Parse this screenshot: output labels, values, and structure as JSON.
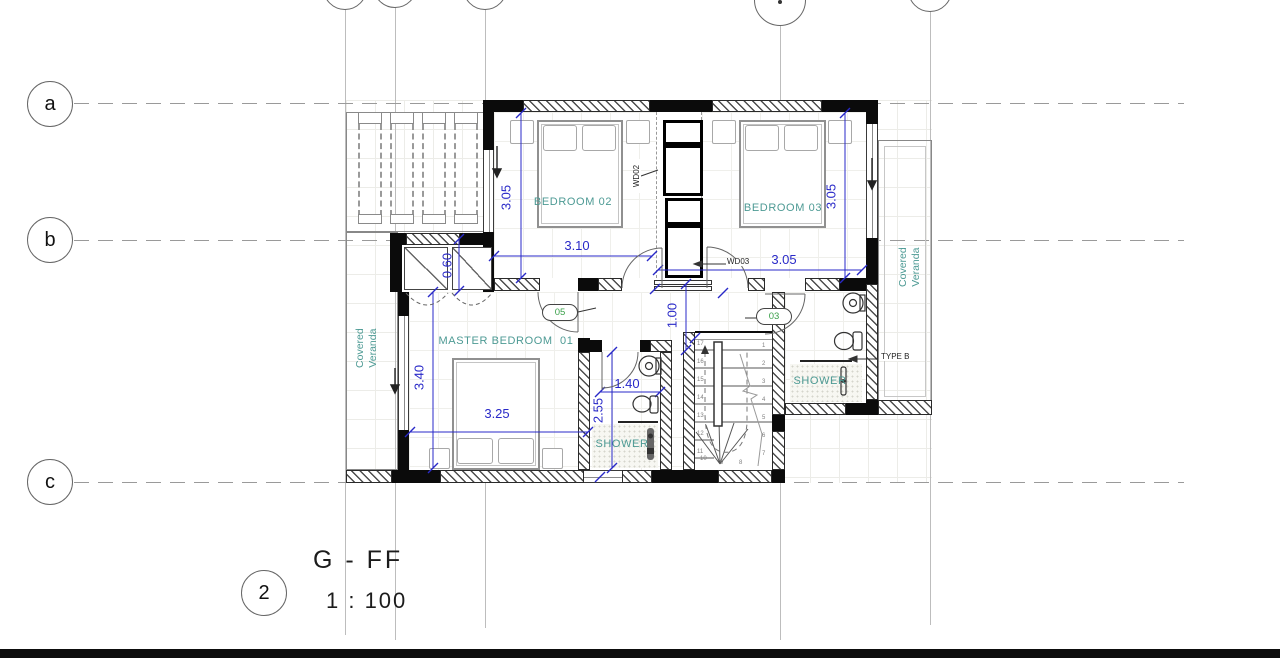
{
  "title_block": {
    "sheet_number": "2",
    "view_title": "G - FF",
    "scale": "1 : 100"
  },
  "grid": {
    "row_labels": [
      "a",
      "b",
      "c"
    ]
  },
  "rooms": {
    "bedroom02": "BEDROOM 02",
    "bedroom03": "BEDROOM 03",
    "master_bedroom": "MASTER BEDROOM  01",
    "shower_ensuite": "SHOWER",
    "shower_bath": "SHOWER",
    "veranda": "Covered Veranda"
  },
  "dimensions": {
    "bedroom02_depth": "3.05",
    "bedroom02_width": "3.10",
    "closet_depth": "0.60",
    "bedroom03_depth": "3.05",
    "bedroom03_width": "3.05",
    "hall_width": "1.00",
    "master_depth": "3.40",
    "master_width": "3.25",
    "ensuite_width": "1.40",
    "ensuite_depth": "2.55"
  },
  "labels": {
    "wd02": "WD02",
    "wd03": "WD03",
    "tag05": "05",
    "tag03": "03",
    "type_b": "TYPE B"
  },
  "stairs": {
    "left_numbers": [
      "17",
      "16",
      "15",
      "14",
      "13",
      "12",
      "11"
    ],
    "right_numbers": [
      "1",
      "2",
      "3",
      "4",
      "5",
      "6",
      "7"
    ],
    "bottom_numbers": [
      "10",
      "9",
      "8"
    ]
  },
  "colors": {
    "dimension_blue": "#2929c8",
    "room_label_teal": "#4d9a94",
    "tag_green": "#3aa04a",
    "wall_black": "#0b0b0b"
  }
}
